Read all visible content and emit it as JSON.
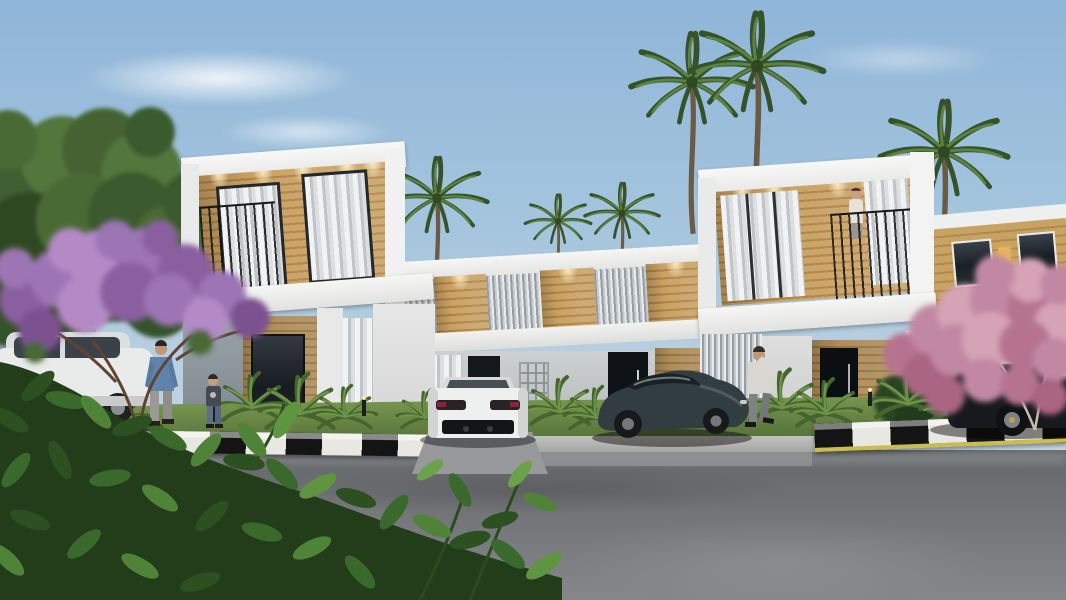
{
  "scene": {
    "kind": "architectural-exterior-render",
    "description": "Dusk 3D architectural rendering of a modern two-storey white villa complex with warm wood-panel accents, sheer-curtained glass doors, recessed downlights and black balcony railings; tall palm trees rise behind the roofline, a purple blossom tree frames the left and a pink blossom tree the right; a white rear-facing sports car and a dark sports car are parked on the driveway by a black-and-white striped kerb, with a white SUV at far left and a black SUV at far right; a man in a denim shirt stands with a child on the left walkway, a man in a light jacket walks while phoning on the right, and a figure stands on the right balcony; a wide wet asphalt road fills the foreground with a leafy bush in the lower-left corner.",
    "time_of_day": "dusk",
    "visible_text": []
  },
  "palette": {
    "sky_top": "#8fb5d8",
    "sky_horizon": "#cfd9e0",
    "building_white": "#f4f4f2",
    "building_gray": "#9aa4ab",
    "wood_light": "#c9a164",
    "wood_dark": "#ad8244",
    "glass_dark": "#1a2025",
    "curtain": "#e9ebec",
    "louver": "#959ca2",
    "railing_black": "#141619",
    "downlight": "#ffeec0",
    "grass": "#5d7a40",
    "shrub_green": "#5f8a3f",
    "hedge_dark": "#2b4522",
    "road_gray": "#6e7073",
    "curb_white": "#e9e7e1",
    "curb_black": "#141414",
    "curb_yellow": "#cabd4e",
    "purple_bloom": "#9d74b4",
    "pink_bloom": "#c288a3",
    "trunk_brown": "#5f4433",
    "trunk_pale": "#c9bcae",
    "car_white": "#eef0f0",
    "car_dark_teal": "#323d42",
    "car_black": "#17191c",
    "skin": "#c29a7c",
    "denim_blue": "#5f83aa",
    "jacket_light": "#d8d7d2"
  },
  "objects": {
    "buildings": [
      {
        "name": "left-villa-tower",
        "features": [
          "white roof band",
          "wood balcony wall",
          "two curtained glass doors",
          "black railing",
          "ceiling downlights",
          "gray ground wall",
          "dark window"
        ]
      },
      {
        "name": "center-wing",
        "features": [
          "louver screens",
          "wood panels",
          "white bands",
          "two dark entry doors",
          "barred window"
        ]
      },
      {
        "name": "right-villa-tower",
        "features": [
          "white roof band",
          "wood balcony wall",
          "sheer curtains",
          "balcony figure",
          "black railing",
          "black entry door"
        ]
      },
      {
        "name": "neighbor-villa",
        "features": [
          "tan upper wall",
          "dark windows",
          "one lit window",
          "white sloped roof band"
        ]
      }
    ],
    "vegetation": [
      "six palm trees",
      "purple blossom tree left",
      "pink blossom tree right",
      "foreground leafy bush",
      "fan shrubs along lawn",
      "dark hedge right"
    ],
    "vehicles": [
      "white suv far left",
      "white sports car rear view",
      "dark sports car",
      "black suv far right"
    ],
    "people": [
      "man in denim shirt",
      "child",
      "man on phone",
      "person on balcony"
    ],
    "road": {
      "surface": "wet asphalt",
      "kerb": "black and white striped with yellow edge line on right",
      "lawn_strip": true,
      "bollard_lights": 4
    }
  }
}
